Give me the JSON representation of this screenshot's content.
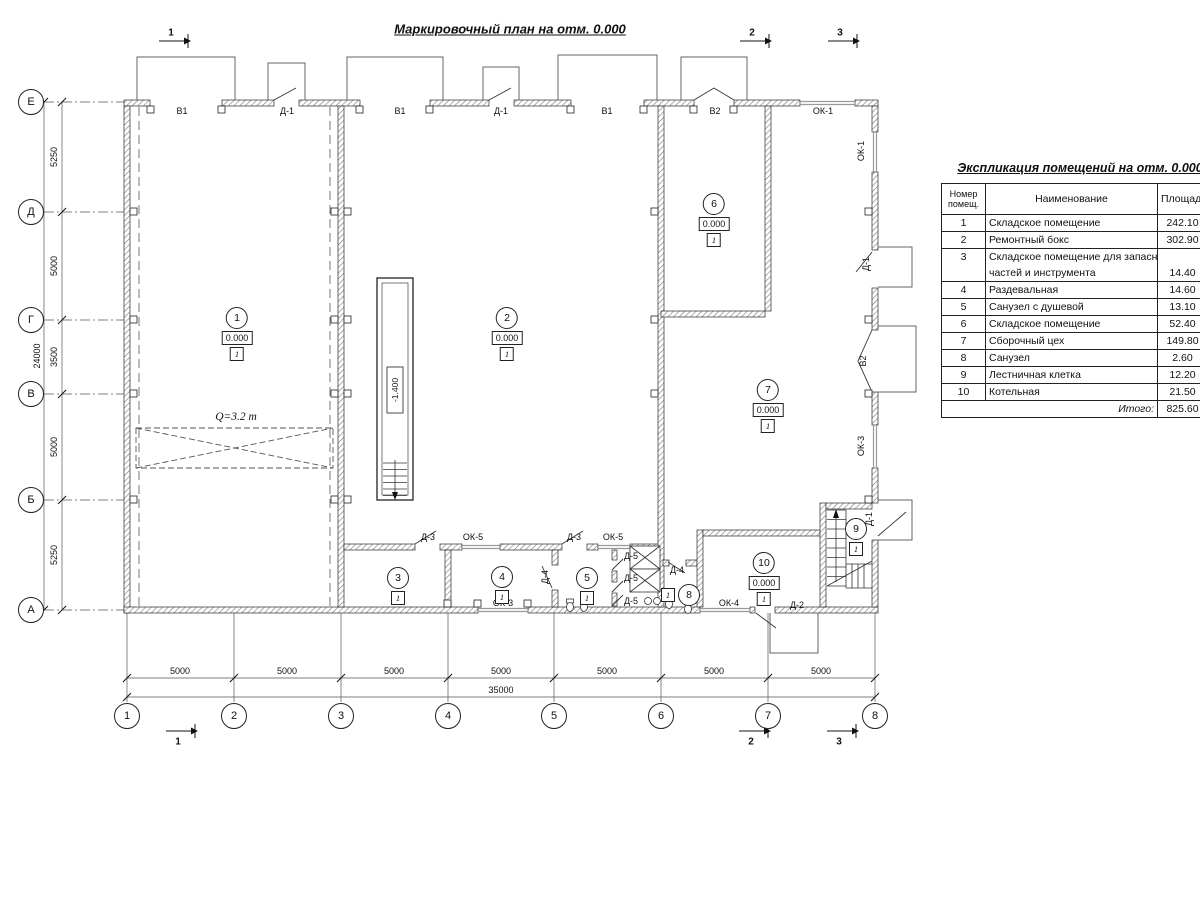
{
  "title": "Маркировочный план на отм. 0.000",
  "axes": {
    "left": [
      "Е",
      "Д",
      "Г",
      "В",
      "Б",
      "А"
    ],
    "bottom": [
      "1",
      "2",
      "3",
      "4",
      "5",
      "6",
      "7",
      "8"
    ]
  },
  "dims": {
    "left": [
      "5250",
      "5000",
      "3500",
      "5000",
      "5250"
    ],
    "left_total": "24000",
    "bottom": [
      "5000",
      "5000",
      "5000",
      "5000",
      "5000",
      "5000",
      "5000"
    ],
    "bottom_total": "35000"
  },
  "sections": {
    "top": [
      "1",
      "2",
      "3"
    ],
    "bottom": [
      "1",
      "2",
      "3"
    ]
  },
  "openings": {
    "top": [
      "В1",
      "Д-1",
      "В1",
      "Д-1",
      "В1",
      "В2",
      "ОК-1"
    ],
    "right": [
      "ОК-1",
      "Д-1",
      "В2",
      "ОК-3",
      "Д-1"
    ],
    "interior": [
      "Д-3",
      "ОК-5",
      "Д-3",
      "ОК-5",
      "Д-5",
      "Д-5",
      "Д-5",
      "Д-4",
      "Д-4",
      "ОК-3",
      "ОК-4",
      "Д-2"
    ]
  },
  "rooms": [
    {
      "num": "1",
      "elev": "0.000",
      "floor": "1"
    },
    {
      "num": "2",
      "elev": "0.000",
      "floor": "1"
    },
    {
      "num": "3",
      "floor": "1"
    },
    {
      "num": "4",
      "floor": "1"
    },
    {
      "num": "5",
      "floor": "1"
    },
    {
      "num": "6",
      "elev": "0.000",
      "floor": "1"
    },
    {
      "num": "7",
      "elev": "0.000",
      "floor": "1"
    },
    {
      "num": "8",
      "floor": "1"
    },
    {
      "num": "9",
      "floor": "1"
    },
    {
      "num": "10",
      "elev": "0.000",
      "floor": "1"
    }
  ],
  "annotations": {
    "crane": "Q=3.2 т",
    "pit_elev": "-1.400"
  },
  "explication": {
    "title": "Экспликация помещений на отм. 0.000",
    "headers": {
      "num": "Номер\nпомещ.",
      "name": "Наименование",
      "area": "Площадь",
      "cat": "Ка\nпо"
    },
    "rows": [
      {
        "num": "1",
        "name": "Складское помещение",
        "area": "242.10"
      },
      {
        "num": "2",
        "name": "Ремонтный бокс",
        "area": "302.90"
      },
      {
        "num": "3",
        "name": "Складское помещение для запасных",
        "area": "",
        "wrap": true
      },
      {
        "num": "",
        "name": "частей и инструмента",
        "area": "14.40",
        "cont": true
      },
      {
        "num": "4",
        "name": "Раздевальная",
        "area": "14.60"
      },
      {
        "num": "5",
        "name": "Санузел с душевой",
        "area": "13.10"
      },
      {
        "num": "6",
        "name": "Складское помещение",
        "area": "52.40"
      },
      {
        "num": "7",
        "name": "Сборочный цех",
        "area": "149.80"
      },
      {
        "num": "8",
        "name": "Санузел",
        "area": "2.60"
      },
      {
        "num": "9",
        "name": "Лестничная клетка",
        "area": "12.20"
      },
      {
        "num": "10",
        "name": "Котельная",
        "area": "21.50"
      }
    ],
    "total_label": "Итого:",
    "total_value": "825.60"
  }
}
